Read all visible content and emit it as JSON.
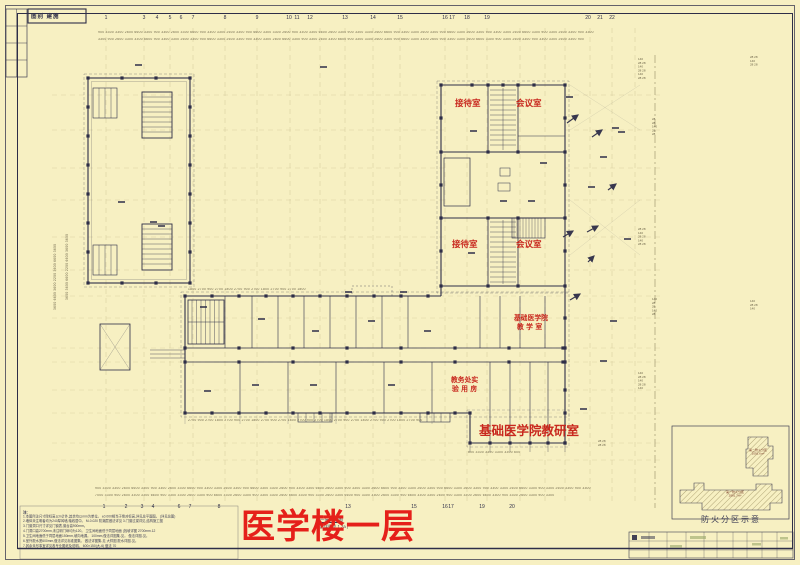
{
  "colors": {
    "paper": "#f7f0c2",
    "line": "#2e2e48",
    "grid": "#bfb383",
    "label_red": "#c8281e",
    "title_red": "#e5201a"
  },
  "stamp": {
    "text": "图别 建施"
  },
  "axes": {
    "top": [
      [
        "1",
        106
      ],
      [
        "3",
        144
      ],
      [
        "4",
        157
      ],
      [
        "5",
        170
      ],
      [
        "6",
        181
      ],
      [
        "7",
        193
      ],
      [
        "8",
        225
      ],
      [
        "9",
        257
      ],
      [
        "10",
        289
      ],
      [
        "11",
        297
      ],
      [
        "12",
        310
      ],
      [
        "13",
        345
      ],
      [
        "14",
        373
      ],
      [
        "15",
        400
      ],
      [
        "16",
        445
      ],
      [
        "17",
        452
      ],
      [
        "18",
        467
      ],
      [
        "19",
        487
      ],
      [
        "20",
        588
      ],
      [
        "21",
        600
      ],
      [
        "22",
        612
      ]
    ],
    "bottom": [
      [
        "1",
        104
      ],
      [
        "2",
        126
      ],
      [
        "3",
        142
      ],
      [
        "4",
        153
      ],
      [
        "6",
        179
      ],
      [
        "7",
        190
      ],
      [
        "8",
        219
      ],
      [
        "13",
        348
      ],
      [
        "15",
        414
      ],
      [
        "16",
        445
      ],
      [
        "17",
        451
      ],
      [
        "19",
        482
      ],
      [
        "20",
        512
      ]
    ]
  },
  "room_labels": [
    {
      "text": "接待室",
      "x": 455,
      "y": 97,
      "size": 8.5
    },
    {
      "text": "会议室",
      "x": 516,
      "y": 97,
      "size": 8.5
    },
    {
      "text": "接待室",
      "x": 452,
      "y": 238,
      "size": 8.5
    },
    {
      "text": "会议室",
      "x": 516,
      "y": 238,
      "size": 8.5
    },
    {
      "text": "基础医学院",
      "x": 514,
      "y": 312,
      "size": 6.8
    },
    {
      "text": "教 学 室",
      "x": 517,
      "y": 321,
      "size": 6.8
    },
    {
      "text": "教务处实",
      "x": 451,
      "y": 374,
      "size": 6.8
    },
    {
      "text": "验 用 房",
      "x": 452,
      "y": 383,
      "size": 6.8
    },
    {
      "text": "基础医学院教研室",
      "x": 479,
      "y": 420,
      "size": 12.5
    }
  ],
  "plan_title": {
    "text": "医学楼一层"
  },
  "subtitle": {
    "line1": "一层平面图",
    "line2": "(局部详图见 1.2a  )"
  },
  "fire_inset": {
    "caption": "防火分区示意",
    "zones": [
      {
        "name": "第二防火分区",
        "area": "2091.6m²",
        "x": 741,
        "y": 449,
        "w": 34
      },
      {
        "name": "第一防火分区",
        "area": "2891.7m²",
        "x": 700,
        "y": 491,
        "w": 70
      }
    ]
  },
  "notes": {
    "heading": "注:",
    "lines": [
      "1.本图所注尺寸除标高以m计外,其余均以mm为单位。    ±0.000相当于绝对标高,详见总平面图。   (详见总图)",
      "2.墙体未注明者均为240厚砖墙,轴线居中。   M-0.020  防潮层做法详见    3.门窗过梁详见,结构施工图",
      "3.门窗洞口尺寸详见门窗表,窗台高900mm。",
      "4.门洞口高2700mm,未注明门垛均为120。  卫生间地面低于同层地面  (找坡详图  2700mm.12",
      "5.卫生间地面低于同层地面150mm,坡向地漏。  100mm,做法详图集-见。   做法详图-见。",
      "6.室外散水宽600mm,做法详见标准图集。  做法详图集-见  大样图   散水详图-见。",
      "7.其余未尽事宜详见各专业图纸及说明。   600×150(大-6)  做法  70"
    ]
  },
  "dim_rows": [
    {
      "x": 98,
      "y": 31,
      "text": "900 3300 3300 2600 6600 3300 900 3300 2600 3300 6600 900 3300 3300 2600 3300 900 6600 3300 3300 2600 900 3300 3300 6600 2600 3300 900 3300 3300 2600 6600 900 3300 3300 2600 3300 900 6600 3300 2600 3300 900 3300 3300 2600 6600 3300 900 3300 2600 3300 900 3300"
    },
    {
      "x": 98,
      "y": 38,
      "text": "3300 900 2600 3300 3300 6600 900 3300 3300 2600 3300 900 6600 3300 2600 3300 900 3300 3300 2600 6600 3300 900 3300 2600 3300 6600 900 3300 3300 2600 3300 900 6600 3300 3300 2600 900 3300 3300 2600 6600 3300 900 3300 2600 3300 900 3300 3300 2600 3300 900"
    },
    {
      "x": 95,
      "y": 487,
      "text": "900 3300 3300 2600 6600 3300 900 3300 2600 3300 6600 900 3300 3300 2600 3300 900 6600 3300 3300 2600 900 3300 3300 6600 2600 3300 900 3300 3300 2600 6600 900 3300 3300 2600 3300 900 6600 3300 2600 3300 900 3300 3300 2600 6600 3300 900 3300 2600 3300 900 3300"
    },
    {
      "x": 95,
      "y": 494,
      "text": "7000 3300 900 2600 3300 3300 6600 900 3300 3300 2600 3300 900 6600 3300 2600 3300 900 3300 3300 2600 6600 3300 900 3300 2600 3300 6600 900 3300 3300 2600 3300 900 6600 3300 3300 2600 900 3300 3300 2600 6600 3300 900 3300 2600 3300 900 3300"
    },
    {
      "x": 188,
      "y": 419,
      "text": "2700 900 2700 1800 2700 900 2700 1800 2700 900 2700 1800 2700 900 2700 1800 2700 900 2700 1800 2700 900 2700 1800 2700 900"
    },
    {
      "x": 468,
      "y": 451,
      "text": "600 3300 3300 3300 3300 600"
    },
    {
      "x": 188,
      "y": 288,
      "text": "1800 2700 900 2700 1800 2700 900 2700 1800 2700 900 2700 1800"
    }
  ],
  "left_dim_cols": [
    {
      "x": 54,
      "y": 310,
      "text": "3600 6600 3600 2200 3600 6600 3600"
    },
    {
      "x": 66,
      "y": 300,
      "text": "3600 3600 6600 2200 6600 3600 3600"
    }
  ],
  "right_stacks": [
    {
      "x": 638,
      "y": 58,
      "lines": "140\n28  28\n140\n28  28\n140\n28  28"
    },
    {
      "x": 638,
      "y": 228,
      "lines": "28  28\n140\n28  28\n140\n28  28"
    },
    {
      "x": 638,
      "y": 372,
      "lines": "140\n28  28\n140\n28  28\n140"
    },
    {
      "x": 652,
      "y": 118,
      "lines": "28\n28\n140\n28\n28"
    },
    {
      "x": 652,
      "y": 298,
      "lines": "140\n28\n28\n140\n28"
    },
    {
      "x": 750,
      "y": 56,
      "lines": "28  28\n140\n28  28"
    },
    {
      "x": 750,
      "y": 300,
      "lines": "140\n28  28\n140"
    },
    {
      "x": 598,
      "y": 440,
      "lines": "28  28\n28  28"
    }
  ]
}
